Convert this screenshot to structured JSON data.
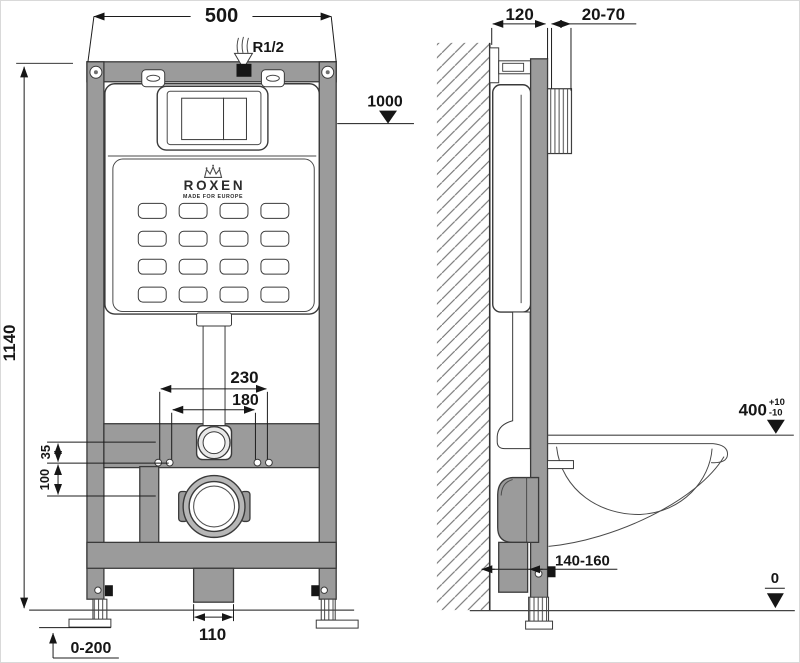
{
  "brand": {
    "name": "ROXEN",
    "tagline": "MADE FOR EUROPE"
  },
  "dims": {
    "width": "500",
    "inlet": "R1/2",
    "height": "1140",
    "level_plate": "1000",
    "depth": "120",
    "finish": "20-70",
    "span_outer": "230",
    "span_inner": "180",
    "offset_small": "35",
    "offset_large": "100",
    "drain_gap": "110",
    "foot_range": "0-200",
    "seat_height": "400",
    "seat_tol_plus": "+10",
    "seat_tol_minus": "-10",
    "drain_out": "140-160",
    "floor": "0"
  },
  "colors": {
    "frame": "#9b9b9b",
    "outline": "#3a3a3a",
    "dim": "#1c1c1c"
  }
}
